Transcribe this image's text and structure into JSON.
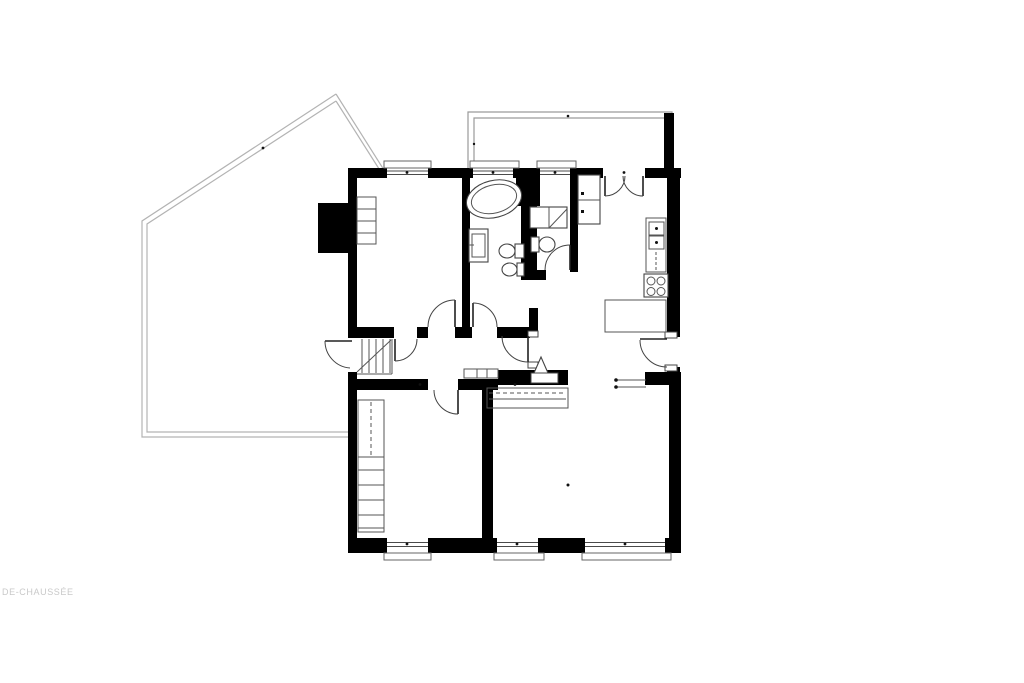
{
  "page": {
    "background": "#ffffff"
  },
  "floorplan": {
    "label": "DE-CHAUSSÉE",
    "label_color": "#c9c9c9",
    "wall_color": "#000000",
    "terrace_outline_color": "#b3b3b3",
    "fixture_color": "#444444",
    "rooms": [
      "terrace",
      "balcony",
      "bedroom-top",
      "bathroom",
      "wc",
      "entry-hall",
      "kitchen",
      "hall",
      "bedroom-bottom",
      "living-room",
      "staircase"
    ],
    "fixtures": [
      "bathtub",
      "washbasin",
      "toilet",
      "bidet",
      "washing-machine",
      "wc-toilet",
      "hall-closet",
      "oven-column",
      "cooktop",
      "kitchen-counter",
      "wardrobe-shelves",
      "built-in-wardrobe",
      "entry-double-door",
      "radiator-line",
      "column-triangle",
      "chimney"
    ]
  }
}
